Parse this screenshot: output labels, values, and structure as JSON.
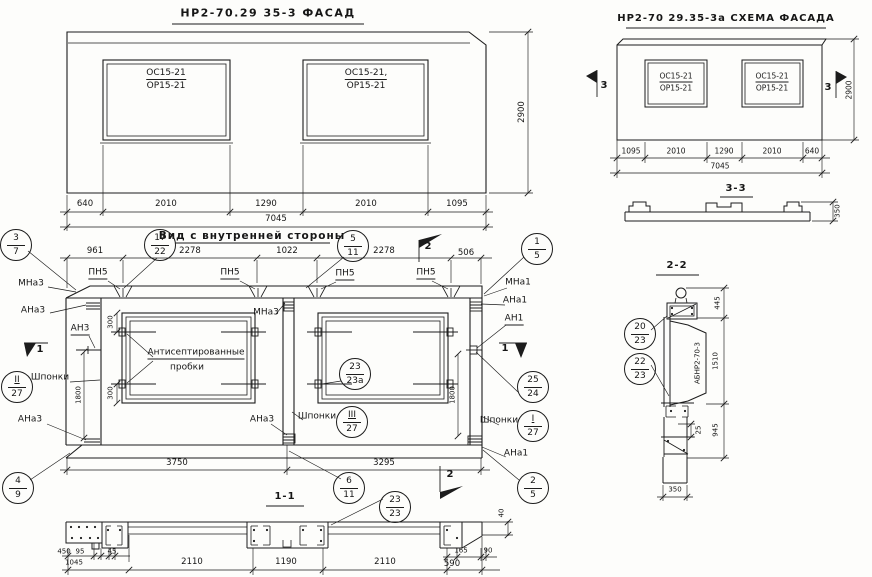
{
  "facade": {
    "title": "НР2-70.29 35-3    ФАСАД",
    "win1_top": "ОС15-21",
    "win1_bot": "ОР15-21",
    "win2_top": "ОС15-21,",
    "win2_bot": "ОР15-21",
    "dims": [
      "640",
      "2010",
      "1290",
      "2010",
      "1095"
    ],
    "total": "7045",
    "height": "2900"
  },
  "schema": {
    "title": "НР2-70 29.35-3а  СХЕМА ФАСАДА",
    "win1_top": "ОС15-21",
    "win1_bot": "ОР15-21",
    "win2_top": "ОС15-21",
    "win2_bot": "ОР15-21",
    "dims": [
      "1095",
      "2010",
      "1290",
      "2010",
      "640"
    ],
    "total": "7045",
    "height": "2900",
    "marker": "3"
  },
  "section33": {
    "title": "3-3",
    "height": "350"
  },
  "internal": {
    "title": "Вид с внутренней стороны",
    "top_dims": [
      "961",
      "2278",
      "1022",
      "2278",
      "506"
    ],
    "bottom_dims": [
      "3750",
      "3295"
    ],
    "pn5": "ПН5",
    "mna3": "МНа3",
    "ana3": "АНа3",
    "an3": "АН3",
    "mna1": "МНа1",
    "ana1": "АНа1",
    "an1": "АН1",
    "shponki": "Шпонки",
    "note_line1": "Антисептированные",
    "note_line2": "пробки",
    "dim300": "300",
    "dim1800": "1800",
    "flag1": "1",
    "flag2": "2"
  },
  "section11": {
    "title": "1-1",
    "sub_dims": [
      "450",
      "95",
      "45"
    ],
    "dims": [
      "1045",
      "2110",
      "1190",
      "2110",
      "590"
    ],
    "sub_right": [
      "165",
      "90"
    ],
    "dim40": "40"
  },
  "section22": {
    "title": "2-2",
    "d445": "445",
    "d1510": "1510",
    "d945": "945",
    "d25": "25",
    "d350": "350",
    "label": "АБНР2-70-3"
  },
  "balloons": {
    "b3_7": {
      "top": "3",
      "bottom": "7"
    },
    "b17_22": {
      "top": "17",
      "bottom": "22"
    },
    "b5_11": {
      "top": "5",
      "bottom": "11"
    },
    "b1_5": {
      "top": "1",
      "bottom": "5"
    },
    "b23_23a": {
      "top": "23",
      "bottom": "23а"
    },
    "b25_24": {
      "top": "25",
      "bottom": "24"
    },
    "bII_27": {
      "top": "II",
      "bottom": "27"
    },
    "bIII_27": {
      "top": "III",
      "bottom": "27"
    },
    "bI_27": {
      "top": "I",
      "bottom": "27"
    },
    "b4_9": {
      "top": "4",
      "bottom": "9"
    },
    "b6_11": {
      "top": "6",
      "bottom": "11"
    },
    "b2_5": {
      "top": "2",
      "bottom": "5"
    },
    "b23_23": {
      "top": "23",
      "bottom": "23"
    },
    "b20_23": {
      "top": "20",
      "bottom": "23"
    },
    "b22_23": {
      "top": "22",
      "bottom": "23"
    }
  }
}
